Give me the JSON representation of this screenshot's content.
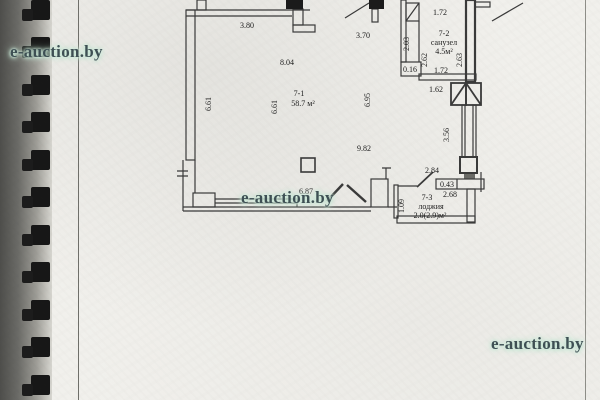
{
  "document": {
    "type": "scanned floor plan page"
  },
  "colors": {
    "paper": "#f1f0ec",
    "ink": "#3a3a3a",
    "thick_wall": "#1b1b1b",
    "binding": "#171717",
    "watermark_text": "#3e5054",
    "watermark_halo": "#bfe2cf"
  },
  "watermarks": [
    {
      "text": "e-auction.by"
    },
    {
      "text": "e-auction.by"
    },
    {
      "text": "e-auction.by"
    }
  ],
  "plan": {
    "rooms": {
      "main": {
        "id": "7-1",
        "area": "58.7 м²"
      },
      "bathroom": {
        "id": "7-2",
        "name": "санузел",
        "area": "4.5м²"
      },
      "loggia": {
        "id": "7-3",
        "name": "лоджия",
        "area": "2.0(2.9)м²"
      }
    },
    "dims": {
      "top_window": "3.80",
      "top_interior": "8.04",
      "entry_door": "3.70",
      "bath_top": "1.72",
      "bath_left_outer": "2.03",
      "bath_left_inner": "2.62",
      "bath_right": "2.63",
      "bath_step": "0.16",
      "bath_bottom": "1.72",
      "corridor": "1.62",
      "left_wall_a": "6.61",
      "left_wall_b": "6.61",
      "right_interior": "6.95",
      "room_width": "9.82",
      "shaft_right": "3.56",
      "loggia_top": "2.84",
      "loggia_step": "0.43",
      "loggia_width": "2.68",
      "bottom_window": "6.87",
      "loggia_left": "1.09"
    }
  }
}
